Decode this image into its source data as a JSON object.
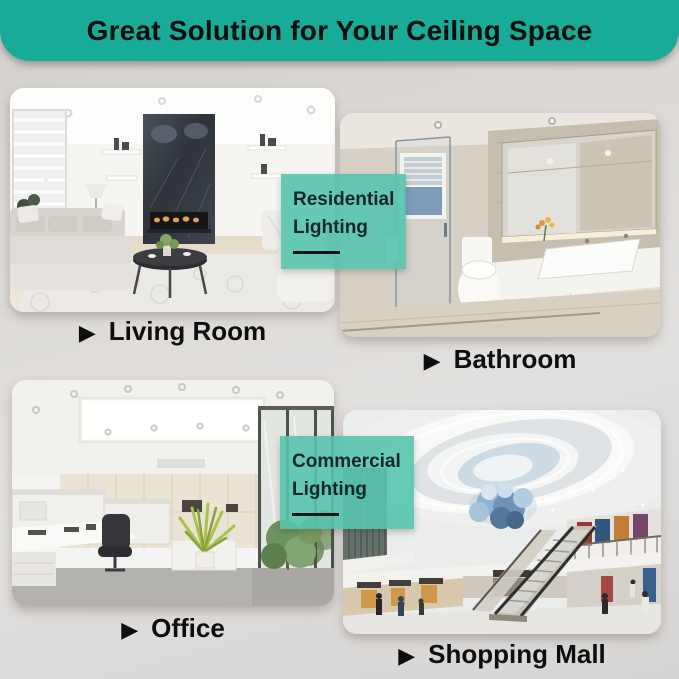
{
  "header": {
    "title": "Great Solution for Your Ceiling Space",
    "background_color": "#17ab98",
    "text_color": "#0c0d0d"
  },
  "labels": {
    "bullet_glyph": "▶"
  },
  "sections": [
    {
      "id": "living-room",
      "label": "Living Room"
    },
    {
      "id": "bathroom",
      "label": "Bathroom"
    },
    {
      "id": "office",
      "label": "Office"
    },
    {
      "id": "shopping-mall",
      "label": "Shopping Mall"
    }
  ],
  "badges": {
    "residential": {
      "line1": "Residential",
      "line2": "Lighting"
    },
    "commercial": {
      "line1": "Commercial",
      "line2": "Lighting"
    },
    "background_color": "#56c4ad",
    "text_color": "#13262b",
    "underline_color": "#141414"
  },
  "photos": [
    {
      "name": "living-room-photo",
      "description": "white living room with recessed ceiling lights, dark fireplace wall, gray sofas, round coffee table"
    },
    {
      "name": "bathroom-photo",
      "description": "beige bathroom with large backlit mirror, vessel sink, toilet and glass shower"
    },
    {
      "name": "office-photo",
      "description": "white office ceiling with recessed downlights, cubicles, glass wall and plants"
    },
    {
      "name": "shopping-mall-photo",
      "description": "mall atrium with swirling cove ceiling, blue cloud light and escalators"
    }
  ]
}
